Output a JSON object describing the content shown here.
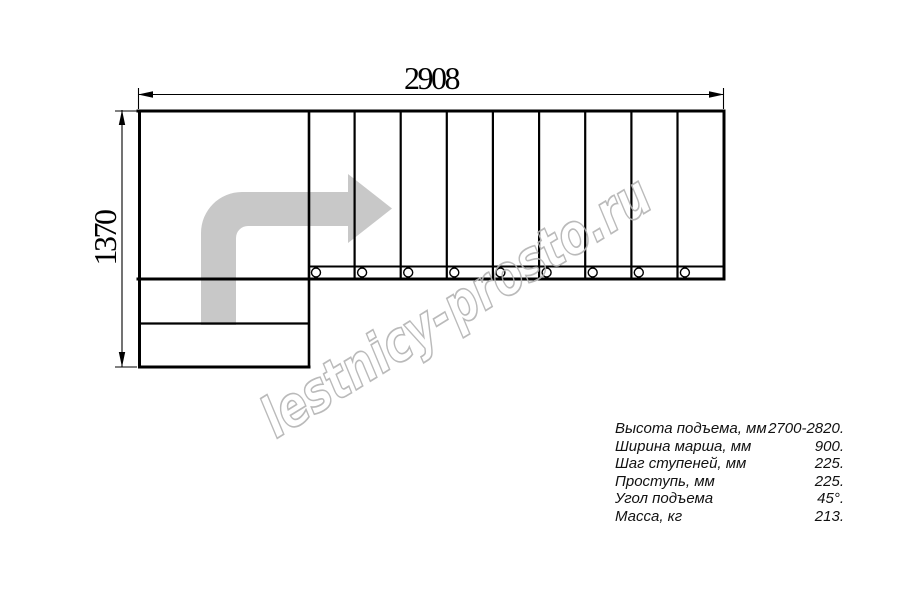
{
  "drawing": {
    "width_label": "2908",
    "height_label": "1370",
    "straight_flight_steps": 9,
    "lower_flight_steps": 2
  },
  "specs": {
    "rows": [
      {
        "label": "Высота подъема, мм",
        "value": "2700-2820."
      },
      {
        "label": "Ширина марша, мм",
        "value": "900."
      },
      {
        "label": "Шаг ступеней, мм",
        "value": "225."
      },
      {
        "label": "Проступь, мм",
        "value": "225."
      },
      {
        "label": "Угол подъема",
        "value": "45°."
      },
      {
        "label": "Масса, кг",
        "value": "213."
      }
    ]
  },
  "watermark": {
    "text": "lestnicy-prosto.ru"
  },
  "colors": {
    "background": "#ffffff",
    "line": "#000000",
    "arrow_fill": "#c8c8c8",
    "watermark_stroke": "#b3b3b3",
    "text": "#111111"
  }
}
